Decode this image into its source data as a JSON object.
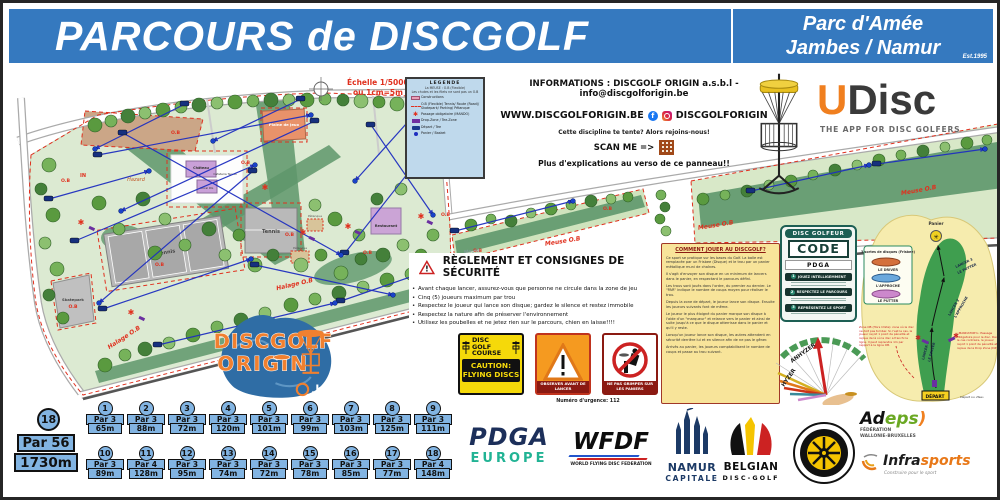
{
  "header": {
    "title": "PARCOURS de DISCGOLF",
    "location_line1": "Parc d'Amée",
    "location_line2": "Jambes / Namur",
    "established": "Est.1995"
  },
  "map": {
    "scale_line1": "Échelle 1/5000",
    "scale_line2": "ou 1cm=5m",
    "labels": {
      "hazard": "Hazard",
      "tennis": "Tennis",
      "skatepark": "Skatepark",
      "petanque": "Pétanque",
      "restaurant": "Restaurant",
      "chateau": "Château",
      "cafeteria": "Cafeteria Tennis",
      "local_dg": "Local DG",
      "plaine": "Plaine de jeux",
      "meuse_ob": "Meuse O.B",
      "halage_ob": "Halage O.B",
      "meuse": "... Meuse",
      "in": "IN",
      "ob": "O.B"
    },
    "legend": {
      "title": "LEGENDE",
      "note_line1": "La MEUSE : O.B (Flexible)",
      "note_line2": "Les chutes et les filets ne sont pas un O.B",
      "items": [
        {
          "label": "Constructions"
        },
        {
          "label": "O.B (Flexible) Tennis/ Route (Road)/ Skatepark/ Parking/ Pétanque"
        },
        {
          "label": "Passage obligatoire (MANDO)"
        },
        {
          "label": "Drop-Zone / Tee-Zone"
        },
        {
          "label": "Départ / Tee"
        },
        {
          "label": "Panier / Basket"
        }
      ]
    }
  },
  "info": {
    "line1": "INFORMATIONS : DISCGOLF ORIGIN a.s.b.l - info@discgolforigin.be",
    "website": "WWW.DISCGOLFORIGIN.BE",
    "social_handle": "DISCGOLFORIGIN",
    "tagline": "Cette discipline te tente? Alors rejoins-nous!",
    "scan": "SCAN ME =>",
    "verso": "Plus d'explications au verso de ce panneau!!"
  },
  "udisc": {
    "brand_u": "U",
    "brand_rest": "Disc",
    "tagline": "THE APP FOR DISC GOLFERS"
  },
  "origin_logo": {
    "line1": "DISCGOLF",
    "line2": "ORIGIN",
    "suffix": ".be"
  },
  "reglement": {
    "title": "RÈGLEMENT ET CONSIGNES DE SÉCURITÉ",
    "rules": [
      "Avant chaque lancer, assurez-vous que personne ne circule dans la zone de jeu",
      "Cinq (5) joueurs maximum par trou",
      "Respectez le joueur qui lance son disque; gardez le silence et restez immobile",
      "Respectez la nature afin de préserver l'environnement",
      "Utilisez les poubelles et ne jetez rien sur le parcours, chien en laisse!!!!"
    ]
  },
  "signs": {
    "course": {
      "line1": "DISC GOLF",
      "line2": "COURSE",
      "caution1": "CAUTION:",
      "caution2": "FLYING DISCS"
    },
    "observe": {
      "label": "OBSERVER AVANT DE LANCER"
    },
    "climb": {
      "label": "NE PAS GRIMPER SUR LES PANIERS"
    }
  },
  "emergency": "Numéro d'urgence: 112",
  "how_to_play": {
    "title": "COMMENT JOUER AU DISCGOLF?",
    "paragraphs": [
      "Ce sport se pratique sur les bases du Golf. La balle est remplacée par un Frisbee (Disque) et le trou par un panier métallique muni de chaînes.",
      "Il s'agit d'envoyer son disque en un minimum de lancers dans le panier, en respectant le parcours défini.",
      "Les trous sont joués dans l'ordre, du premier au dernier. Le \"PAR\" indique le nombre de coups moyen pour réaliser le trou.",
      "Depuis la zone de départ, le joueur lance son disque. Ensuite les joueurs suivants font de même.",
      "Le joueur le plus éloigné du panier marque son disque à l'aide d'un \"marqueur\" et relance vers le panier et ainsi de suite jusqu'à ce que le disque atterrisse dans le panier et qu'il y reste.",
      "Lorsqu'un joueur lance son disque, les autres attendent en sécurité derrière lui et en silence afin de ne pas le gêner.",
      "Arrivés au panier, les joueurs comptabilisent le nombre de coups et passe au trou suivant.",
      "A la fin du parcours, le nombre de coups sur chaque trou sont additionnés. Le gagnant est celui qui possède le moins de points."
    ]
  },
  "code_badge": {
    "top": "DISC GOLFEUR",
    "middle": "CODE",
    "pdga": "PDGA",
    "items": [
      {
        "num": "1",
        "label": "JOUEZ INTELLIGEMMENT"
      },
      {
        "num": "2",
        "label": "RESPECTEZ LE PARCOURS"
      },
      {
        "num": "3",
        "label": "REPRÉSENTEZ LE SPORT"
      }
    ]
  },
  "throw_diagram": {
    "anhyzer": "ANHYZER",
    "hyzer": "HYZER"
  },
  "hole_diagram": {
    "panier_label": "Panier",
    "discs_title": "3 sortes de disques (Frisbee)",
    "disc1": "LE DRIVER",
    "disc2": "L'APPROCHE",
    "disc3": "LE PUTTER",
    "lancer1_line1": "LANCER 1",
    "lancer1_line2": "LE DRIVER",
    "lancer2_line1": "LANCER 2",
    "lancer2_line2": "L'APPROCHE",
    "lancer3_line1": "LANCER 3",
    "lancer3_line2": "LE PUTTER",
    "depart_label": "DÉPART",
    "depart_note": "Départ ou «Tee»",
    "ob_note": "Zone OB (Hors limite): zone où le disc ne doit pas tomber. Si c'est le cas, le joueur reçoit 1 point de pénalité et rejoue de là où le disc a franchi la ligne. Il peut reprendre 1m par rapport à la ligne OB.",
    "mando_note": "«MANDATORY»: Passage obligatoire pour le disc. Dans le cas contraire, le joueur reçoit 1 point de pénalité et rejoue de la Drop Zone (DZ)."
  },
  "course_summary": {
    "holes": "18",
    "par": "Par 56",
    "distance": "1730m"
  },
  "holes": [
    {
      "number": "1",
      "par": "Par 3",
      "distance": "65m"
    },
    {
      "number": "2",
      "par": "Par 3",
      "distance": "88m"
    },
    {
      "number": "3",
      "par": "Par 3",
      "distance": "72m"
    },
    {
      "number": "4",
      "par": "Par 3",
      "distance": "120m"
    },
    {
      "number": "5",
      "par": "Par 3",
      "distance": "101m"
    },
    {
      "number": "6",
      "par": "Par 3",
      "distance": "99m"
    },
    {
      "number": "7",
      "par": "Par 3",
      "distance": "103m"
    },
    {
      "number": "8",
      "par": "Par 3",
      "distance": "125m"
    },
    {
      "number": "9",
      "par": "Par 3",
      "distance": "111m"
    },
    {
      "number": "10",
      "par": "Par 3",
      "distance": "89m"
    },
    {
      "number": "11",
      "par": "Par 4",
      "distance": "128m"
    },
    {
      "number": "12",
      "par": "Par 3",
      "distance": "95m"
    },
    {
      "number": "13",
      "par": "Par 3",
      "distance": "74m"
    },
    {
      "number": "14",
      "par": "Par 3",
      "distance": "72m"
    },
    {
      "number": "15",
      "par": "Par 3",
      "distance": "78m"
    },
    {
      "number": "16",
      "par": "Par 3",
      "distance": "85m"
    },
    {
      "number": "17",
      "par": "Par 3",
      "distance": "77m"
    },
    {
      "number": "18",
      "par": "Par 4",
      "distance": "148m"
    }
  ],
  "partners": {
    "pdga": {
      "name": "PDGA",
      "region": "EUROPE"
    },
    "wfdf": {
      "name": "WFDF",
      "sub": "WORLD FLYING DISC FEDERATION"
    },
    "namur": {
      "line1": "NAMUR",
      "line2": "CAPITALE"
    },
    "belgian": {
      "line1": "BELGIAN",
      "line2": "DISC-GOLF"
    },
    "adeps": {
      "name_black": "Ad",
      "name_green": "eps",
      "sub1": "FÉDÉRATION",
      "sub2": "WALLONIE-BRUXELLES"
    },
    "infrasports": {
      "name_black": "Infra",
      "name_orange": "sports",
      "sub": "Construire pour le sport"
    }
  }
}
